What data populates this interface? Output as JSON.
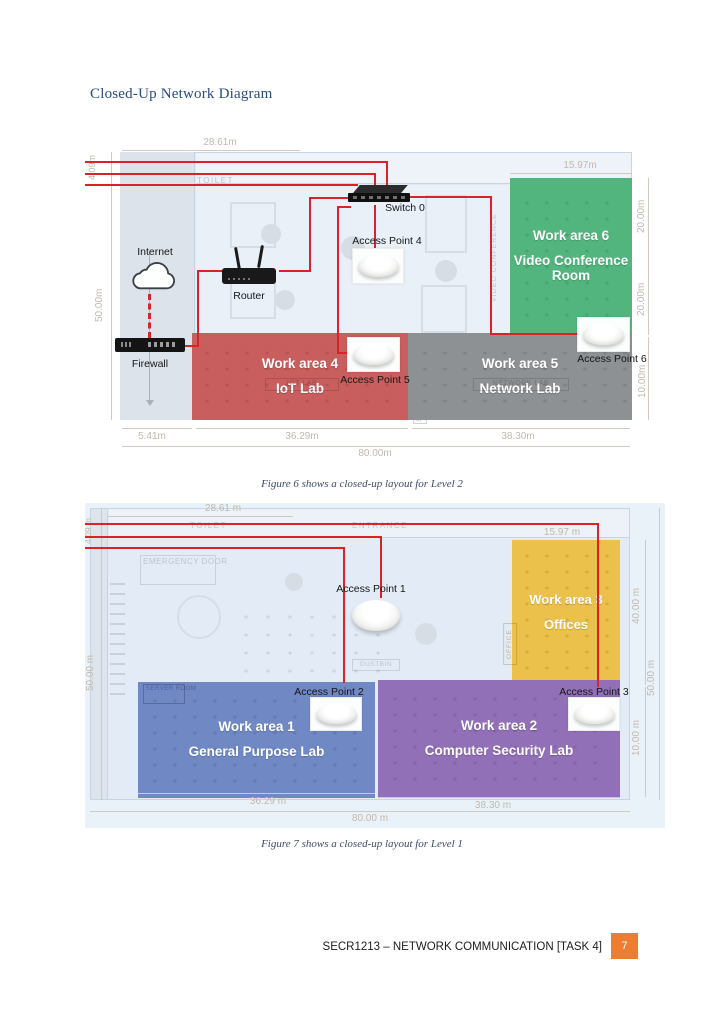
{
  "page": {
    "title": "Closed-Up Network Diagram",
    "background": "#ffffff"
  },
  "footer": {
    "course_code": "SECR1213 – NETWORK COMMUNICATION [TASK 4]",
    "page_number": "7",
    "page_box_color": "#ed7d31"
  },
  "level2": {
    "caption": "Figure 6 shows a closed-up layout for Level 2",
    "line_color": "#dc2127",
    "devices": {
      "internet": "Internet",
      "router": "Router",
      "switch": "Switch 0",
      "firewall": "Firewall",
      "ap4": "Access Point 4",
      "ap5": "Access Point 5",
      "ap6": "Access Point 6"
    },
    "rooms": [
      {
        "name": "Work area 6",
        "subtitle": "Video Conference Room",
        "color": "#53b57e"
      },
      {
        "name": "Work area 4",
        "subtitle": "IoT Lab",
        "color": "#c95e5e"
      },
      {
        "name": "Work area 5",
        "subtitle": "Network Lab",
        "color": "#8e9193"
      }
    ],
    "dimensions": {
      "top_width": "28.61m",
      "conference_width": "15.97m",
      "right_upper": "20.00m",
      "right_lower": "20.00m",
      "right_bottom": "10.00m",
      "left_height": "50.00m",
      "left_top": "4.09m",
      "bottom_left": "5.41m",
      "bottom_mid": "36.29m",
      "bottom_right": "38.30m",
      "bottom_total": "80.00m"
    },
    "floor_labels": {
      "toilet": "TOILET",
      "video_conference": "VIDEO CONFERENCE",
      "server_room_1": "SERVER ROOM",
      "server_room_2": "SERVER ROOM",
      "iot_lab": "IOT LAB",
      "network_lab": "NETWORK LAB"
    }
  },
  "level1": {
    "caption": "Figure 7 shows a closed-up layout for Level 1",
    "line_color": "#dc2127",
    "devices": {
      "ap1": "Access Point 1",
      "ap2": "Access Point 2",
      "ap3": "Access Point 3"
    },
    "rooms": [
      {
        "name": "Work area 3",
        "subtitle": "Offices",
        "color": "#ecc14b"
      },
      {
        "name": "Work area 1",
        "subtitle": "General Purpose Lab",
        "color": "#7089c4"
      },
      {
        "name": "Work area 2",
        "subtitle": "Computer Security Lab",
        "color": "#9270b8"
      }
    ],
    "dimensions": {
      "top_width": "28.61 m",
      "offices_width": "15.97 m",
      "right_upper": "40.00 m",
      "right_outer": "50.00 m",
      "right_lower": "10.00 m",
      "left_height": "50.00 m",
      "left_top": "4.09 m",
      "bottom_left": "36.29 m",
      "bottom_right": "38.30 m",
      "bottom_total": "80.00 m"
    },
    "floor_labels": {
      "toilet": "TOILET",
      "entrance": "ENTRANCE",
      "emergency_door": "EMERGENCY DOOR",
      "dustbin": "DUSTBIN",
      "server_room": "SERVER ROOM",
      "office": "OFFICE"
    }
  }
}
